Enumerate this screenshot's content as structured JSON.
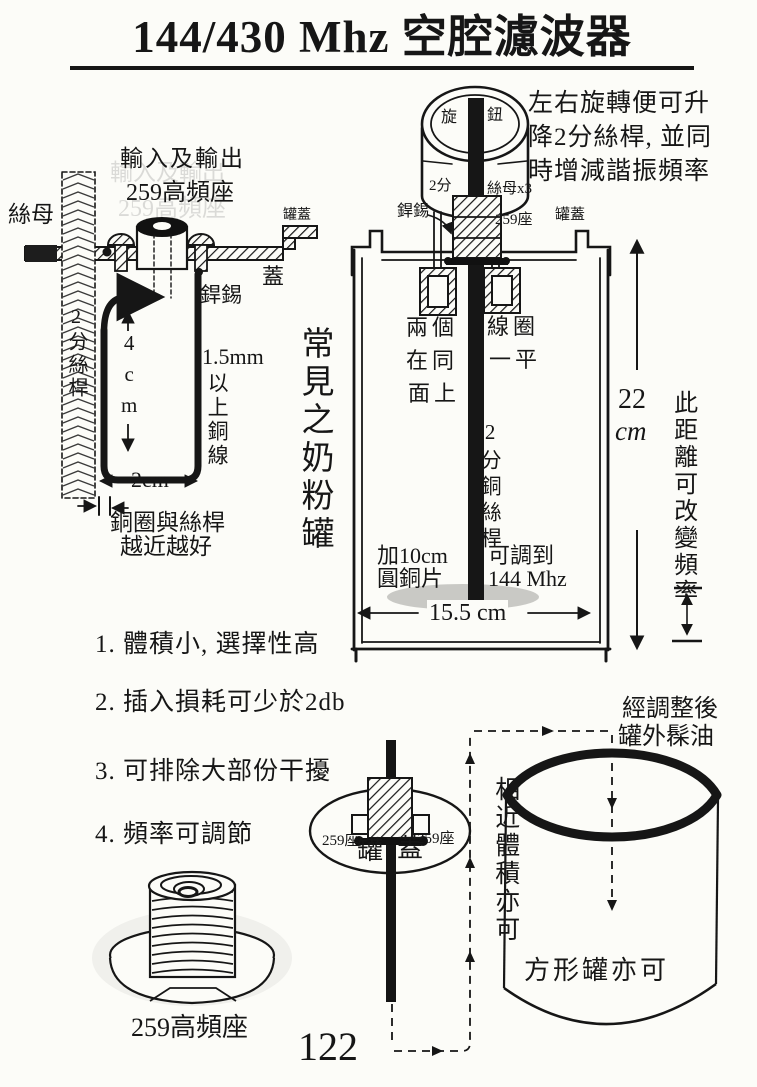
{
  "page": {
    "title": "144/430 Mhz 空腔濾波器",
    "page_number": "122"
  },
  "colors": {
    "paper": "#fcfcf8",
    "ink": "#161616",
    "disc_gray": "#c9c9c5"
  },
  "top_right_note": {
    "lines": [
      "左右旋轉便可升",
      "降2分絲桿, 並同",
      "時增減諧振頻率"
    ]
  },
  "left_diagram": {
    "io_line1": "輸入及輸出",
    "io_line2": "259高頻座",
    "nut_label": "絲母",
    "rod_label": "2分絲桿",
    "can_lid_label": "罐蓋",
    "lid_label": "蓋",
    "solder_label": "銲錫",
    "height_label": "4cm",
    "wire_size_label": "1.5mm",
    "wire_note": "以上銅線",
    "width_label": "2cm",
    "gap_note1": "銅圈與絲桿",
    "gap_note2": "越近越好"
  },
  "can_diagram": {
    "caption": "常見之奶粉罐",
    "knob_left": "旋",
    "knob_right": "鈕",
    "rod_size_label": "2分",
    "nuts_label": "絲母x3",
    "solder_label": "銲錫",
    "socket_label": "259座",
    "lid_label": "罐蓋",
    "coil_note_left": [
      "兩個",
      "在同",
      "面上"
    ],
    "coil_note_right": [
      "線圈",
      "一平"
    ],
    "rod_label": "2分銅絲桿",
    "disc_note1": "加10cm",
    "disc_note2": "圓銅片",
    "tune_note1": "可調到",
    "tune_note2": "144 Mhz",
    "diameter_label": "15.5 cm"
  },
  "height_dim": {
    "value": "22",
    "unit": "cm",
    "note": "此距離可改變頻率"
  },
  "features": [
    "1. 體積小, 選擇性高",
    "2. 插入損耗可少於2db",
    "3. 可排除大部份干擾",
    "4. 頻率可調節"
  ],
  "bottom": {
    "connector_label": "259高頻座",
    "top_view": {
      "socket_left": "259座",
      "socket_right": "259座",
      "lid_char_l": "罐",
      "lid_char_r": "蓋"
    },
    "alt_can": {
      "note_line1": "經調整後",
      "note_line2": "罐外髹油",
      "side_note": "相近體積亦可",
      "inner_note": "方形罐亦可"
    }
  }
}
